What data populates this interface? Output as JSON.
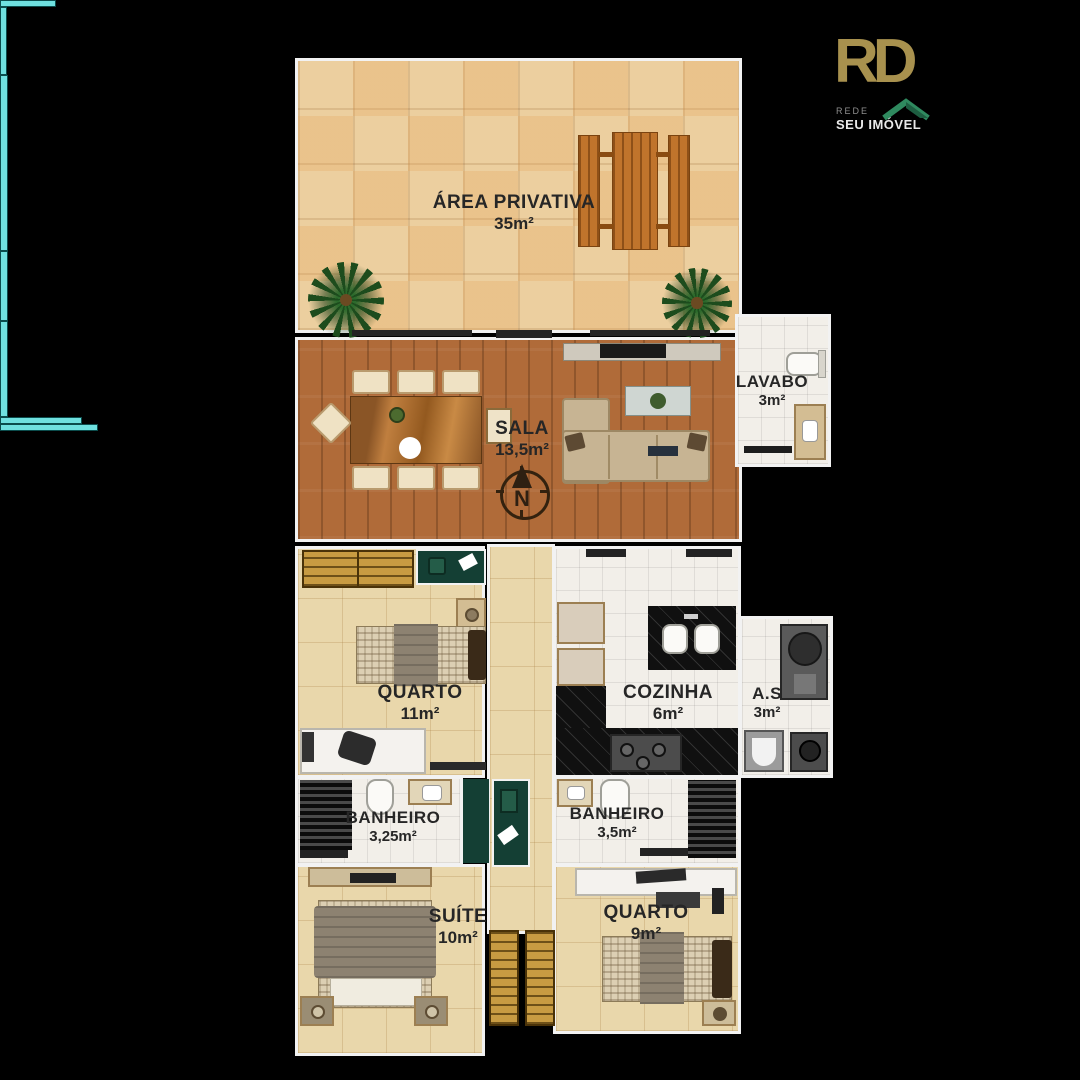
{
  "page": {
    "background": "#000000"
  },
  "logo": {
    "brand": "RD",
    "sub_top": "REDE",
    "sub_bottom": "SEU IMÓVEL",
    "brand_color": "#a8914e",
    "roof_color": "#2f8a5f"
  },
  "compass": {
    "label": "N"
  },
  "rooms": [
    {
      "id": "area-privativa",
      "name": "ÁREA PRIVATIVA",
      "area": "35m²"
    },
    {
      "id": "sala",
      "name": "SALA",
      "area": "13,5m²"
    },
    {
      "id": "lavabo",
      "name": "LAVABO",
      "area": "3m²"
    },
    {
      "id": "quarto-11",
      "name": "QUARTO",
      "area": "11m²"
    },
    {
      "id": "cozinha",
      "name": "COZINHA",
      "area": "6m²"
    },
    {
      "id": "as",
      "name": "A.S",
      "area": "3m²"
    },
    {
      "id": "banheiro-325",
      "name": "BANHEIRO",
      "area": "3,25m²"
    },
    {
      "id": "banheiro-35",
      "name": "BANHEIRO",
      "area": "3,5m²"
    },
    {
      "id": "suite",
      "name": "SUÍTE",
      "area": "10m²"
    },
    {
      "id": "quarto-9",
      "name": "QUARTO",
      "area": "9m²"
    }
  ],
  "colors": {
    "wall_outline": "#f2f2f2",
    "window_glass": "#6fe0df",
    "terrace_tile": "#eccf9f",
    "wood_floor": "#b06b39",
    "bedroom_tile": "#e9d7ab",
    "bath_tile": "#f2efe9",
    "kitchen_marble": "#101010",
    "decor_green": "#143f34"
  }
}
